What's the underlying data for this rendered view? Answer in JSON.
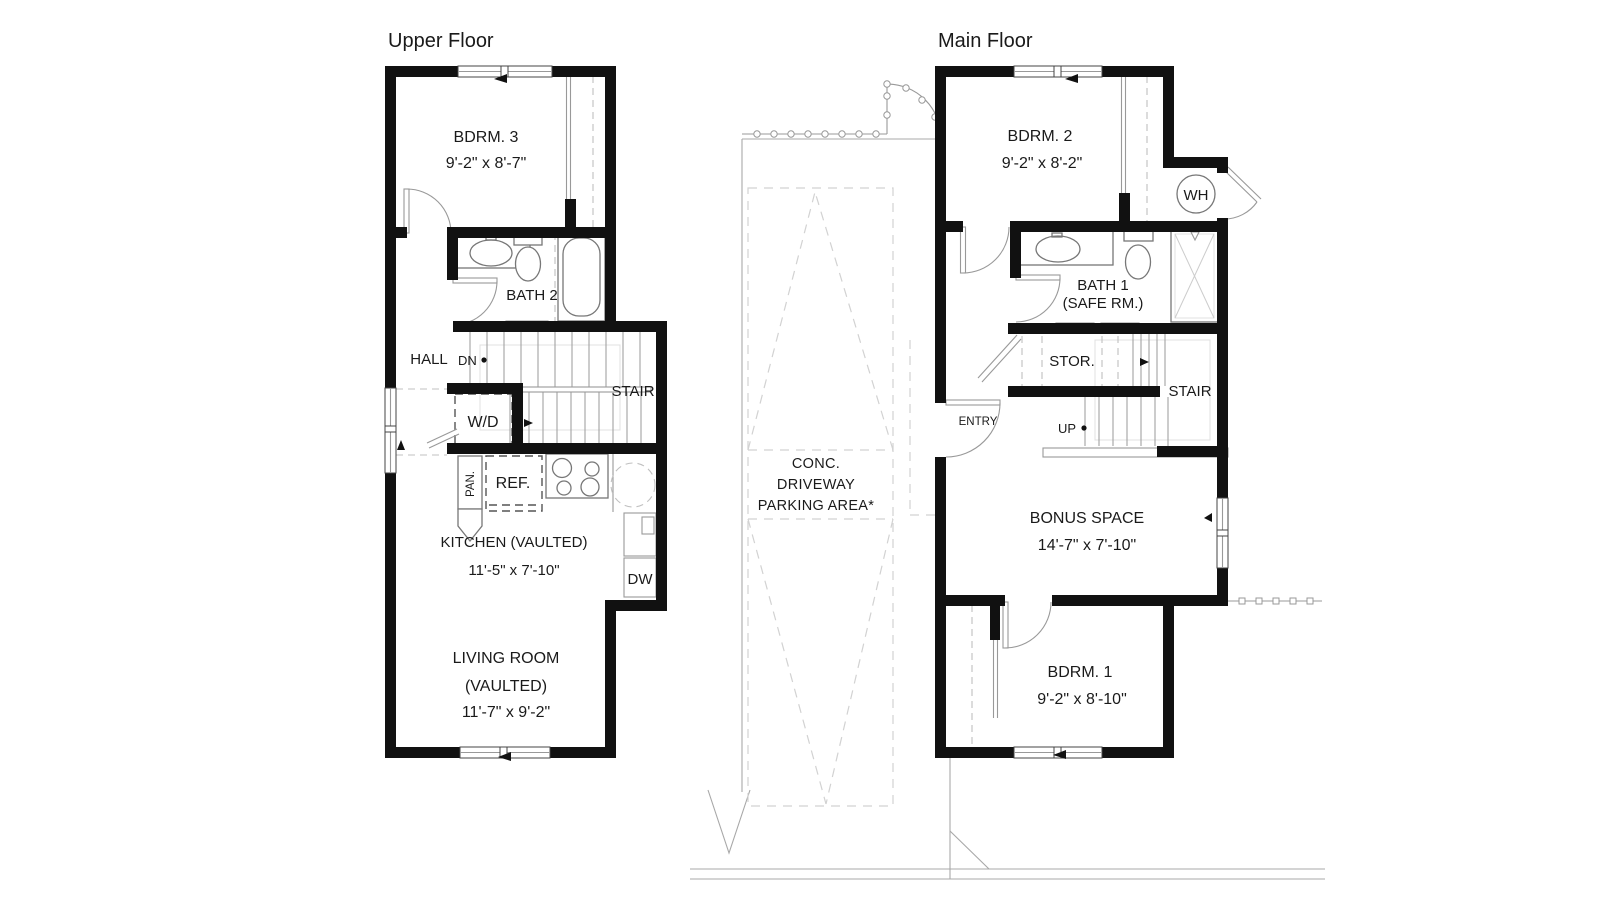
{
  "upper_floor": {
    "title": "Upper Floor",
    "bedroom3": {
      "name": "BDRM. 3",
      "dims": "9'-2\" x 8'-7\""
    },
    "bath2": {
      "name": "BATH 2"
    },
    "hall": {
      "name": "HALL"
    },
    "stair": {
      "label": "STAIR",
      "direction": "DN"
    },
    "laundry": {
      "name": "W/D"
    },
    "pantry": {
      "name": "PAN."
    },
    "fridge": {
      "name": "REF."
    },
    "kitchen": {
      "name": "KITCHEN (VAULTED)",
      "dims": "11'-5\" x 7'-10\""
    },
    "dishwasher": {
      "name": "DW"
    },
    "living": {
      "line1": "LIVING ROOM",
      "line2": "(VAULTED)",
      "dims": "11'-7\" x 9'-2\""
    }
  },
  "main_floor": {
    "title": "Main Floor",
    "bedroom2": {
      "name": "BDRM. 2",
      "dims": "9'-2\" x 8'-2\""
    },
    "water_heater": {
      "name": "WH"
    },
    "bath1": {
      "line1": "BATH 1",
      "line2": "(SAFE RM.)"
    },
    "storage": {
      "name": "STOR."
    },
    "stair": {
      "label": "STAIR",
      "direction": "UP"
    },
    "entry": {
      "name": "ENTRY"
    },
    "bonus": {
      "name": "BONUS SPACE",
      "dims": "14'-7\" x 7'-10\""
    },
    "bedroom1": {
      "name": "BDRM. 1",
      "dims": "9'-2\" x 8'-10\""
    }
  },
  "site": {
    "driveway": {
      "line1": "CONC.",
      "line2": "DRIVEWAY",
      "line3": "PARKING AREA*"
    }
  },
  "colors": {
    "wall": "#111111",
    "fixture": "#777777",
    "site_line": "#a8a8a8",
    "dash": "#c0c0c0",
    "background": "#ffffff"
  }
}
